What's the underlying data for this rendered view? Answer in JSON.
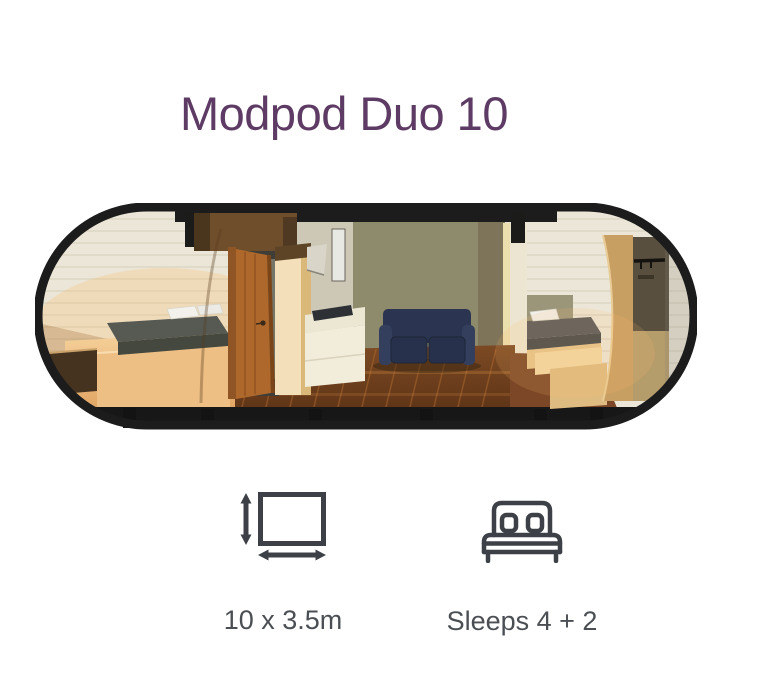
{
  "page": {
    "title": "Modpod Duo 10"
  },
  "colors": {
    "title": "#5e3b64",
    "icon": "#3d4147",
    "label": "#4b4f54",
    "outline": "#1c1c1c"
  },
  "specs": [
    {
      "icon": "dimensions-icon",
      "label": "10 x 3.5m"
    },
    {
      "icon": "double-bed-icon",
      "label": "Sleeps 4 + 2"
    }
  ]
}
